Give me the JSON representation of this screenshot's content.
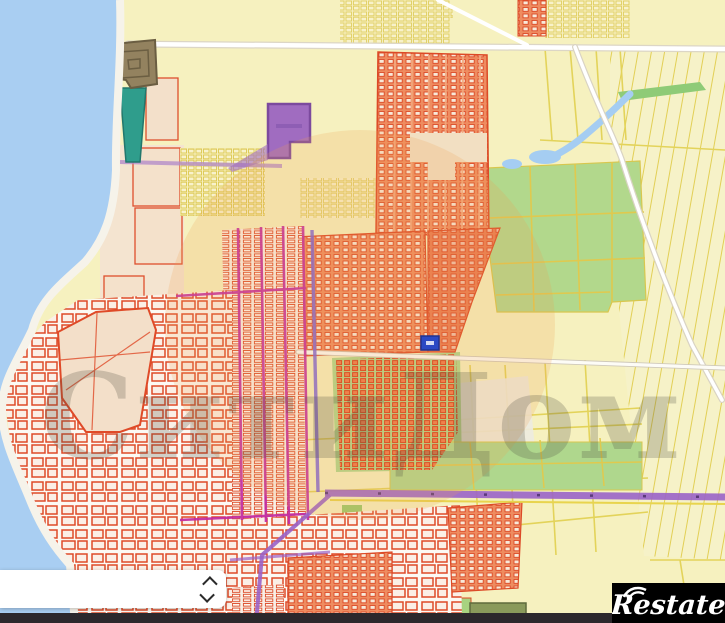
{
  "map": {
    "watermark": {
      "text": "СитиДом"
    },
    "brand": {
      "logo_text": "Restate"
    },
    "marker": {
      "kind": "selected-parcel"
    },
    "legend_colors": {
      "water": "#A9CEF2",
      "fields_yellow": "#F6F1BF",
      "greenery": "#B2D88C",
      "cadastral_red": "#DD4B28",
      "parcel_fill": "#EE8C60",
      "road_magenta": "#C22BA2",
      "road_purple": "#9A63C8",
      "zone_purple": "#9F6CC2",
      "zone_teal": "#2F9D8C",
      "building_brown": "#93825F",
      "beach": "#F5E9D6",
      "marker_blue": "#2B49C4",
      "watermark_tint": "#EFA050"
    }
  },
  "controls": {
    "expander": {
      "icon_up": "chevron-up",
      "icon_down": "chevron-down"
    }
  }
}
